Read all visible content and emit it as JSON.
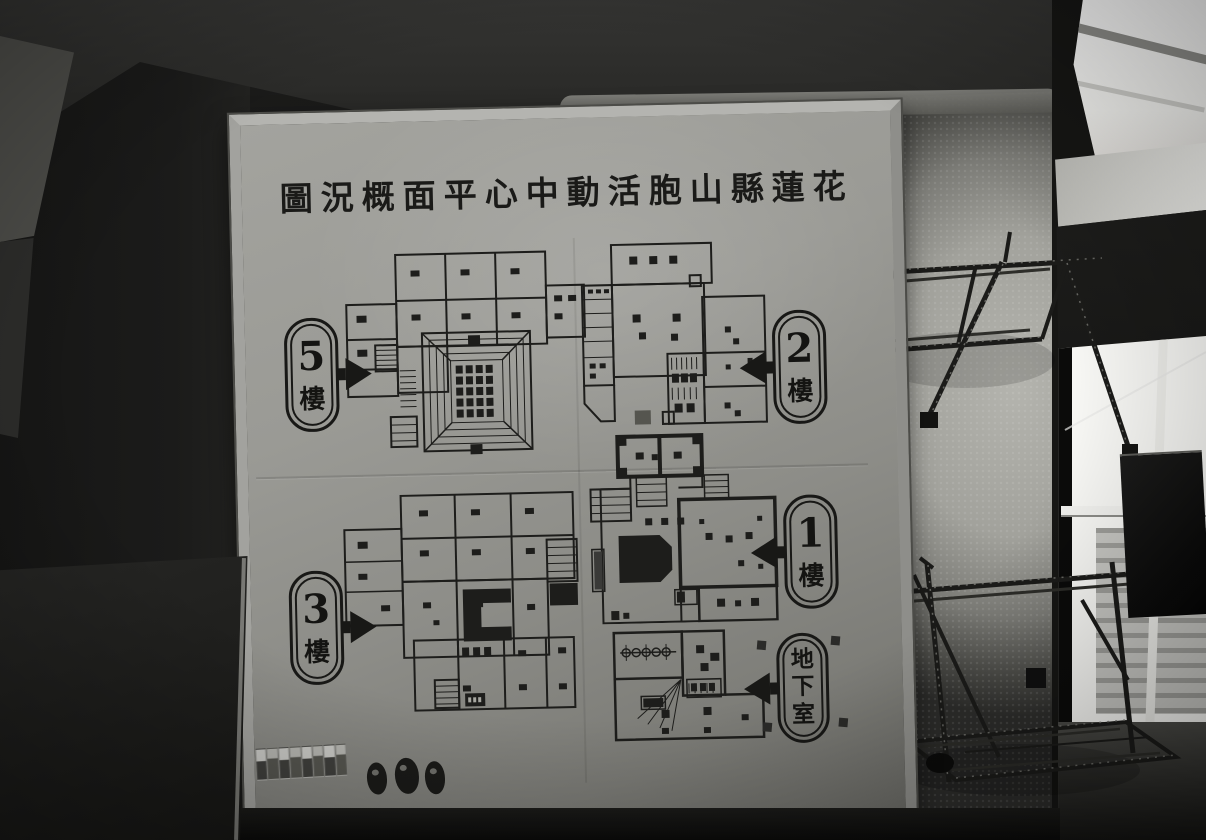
{
  "sign_board": {
    "title": "圖況概面平心中動活胞山縣蓮花",
    "floor_labels": [
      {
        "id": "5f",
        "number": "5",
        "suffix": "樓",
        "arrow_direction": "right"
      },
      {
        "id": "2f",
        "number": "2",
        "suffix": "樓",
        "arrow_direction": "left"
      },
      {
        "id": "3f",
        "number": "3",
        "suffix": "樓",
        "arrow_direction": "right"
      },
      {
        "id": "1f",
        "number": "1",
        "suffix": "樓",
        "arrow_direction": "left"
      },
      {
        "id": "basement",
        "text": "地下室",
        "arrow_direction": "left"
      }
    ],
    "photo_strip": {
      "thumbnail_count": 8
    },
    "sticker_count": 3
  },
  "colors": {
    "ink": "#1c1c1c",
    "board_face": "#94948f",
    "board_frame": "#b0b0ac",
    "wall_light": "#b4b4ae",
    "window_light": "#fafafa",
    "metal_shelf": "#1b1b1b",
    "shadow_dark": "#141412"
  }
}
